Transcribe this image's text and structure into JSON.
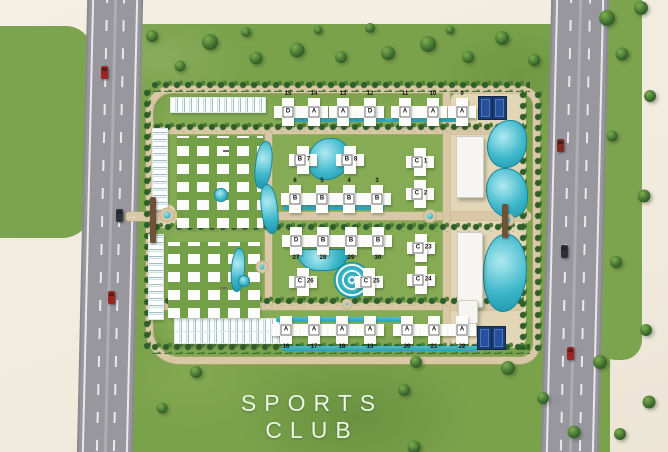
{
  "caption": {
    "line1": "SPORTS",
    "line2": "CLUB"
  },
  "entrances": {
    "west_arrow": "→",
    "east_arrow": "←"
  },
  "colors": {
    "background_cream": "#f2ecdf",
    "grass_green": "#7aa24b",
    "road_gray": "#98979d",
    "internal_road_tan": "#d8c8a6",
    "pool_teal": "#3fb8cb",
    "court_blue": "#1c3c74",
    "building_white": "#fcfcfa",
    "caption_green_white": "#e9f6e4"
  },
  "map": {
    "buildings": [
      {
        "num": "15",
        "letter": "D",
        "cls": "np-top",
        "x": 288,
        "y": 112
      },
      {
        "num": "14",
        "letter": "A",
        "cls": "np-top",
        "x": 314,
        "y": 112
      },
      {
        "num": "13",
        "letter": "A",
        "cls": "np-top",
        "x": 343,
        "y": 112
      },
      {
        "num": "12",
        "letter": "D",
        "cls": "np-top",
        "x": 370,
        "y": 112
      },
      {
        "num": "11",
        "letter": "A",
        "cls": "np-top",
        "x": 405,
        "y": 112
      },
      {
        "num": "10",
        "letter": "A",
        "cls": "np-top",
        "x": 433,
        "y": 112
      },
      {
        "num": "9",
        "letter": "A",
        "cls": "np-top",
        "x": 462,
        "y": 112
      },
      {
        "num": "7",
        "letter": "B",
        "cls": "np-right",
        "x": 303,
        "y": 160
      },
      {
        "num": "8",
        "letter": "B",
        "cls": "np-right",
        "x": 350,
        "y": 160
      },
      {
        "num": "1",
        "letter": "C",
        "cls": "np-right",
        "x": 420,
        "y": 162
      },
      {
        "num": "2",
        "letter": "C",
        "cls": "np-right",
        "x": 420,
        "y": 194
      },
      {
        "num": "6",
        "letter": "B",
        "cls": "np-top",
        "x": 295,
        "y": 199
      },
      {
        "num": "5",
        "letter": "B",
        "cls": "np-top",
        "x": 322,
        "y": 199
      },
      {
        "num": "4",
        "letter": "B",
        "cls": "np-top",
        "x": 349,
        "y": 199
      },
      {
        "num": "3",
        "letter": "B",
        "cls": "np-top",
        "x": 377,
        "y": 199
      },
      {
        "num": "27",
        "letter": "D",
        "cls": "np-bottom",
        "x": 296,
        "y": 241
      },
      {
        "num": "28",
        "letter": "B",
        "cls": "np-bottom",
        "x": 323,
        "y": 241
      },
      {
        "num": "29",
        "letter": "B",
        "cls": "np-bottom",
        "x": 351,
        "y": 241
      },
      {
        "num": "30",
        "letter": "B",
        "cls": "np-bottom",
        "x": 378,
        "y": 241
      },
      {
        "num": "23",
        "letter": "C",
        "cls": "np-right",
        "x": 421,
        "y": 248
      },
      {
        "num": "24",
        "letter": "C",
        "cls": "np-right",
        "x": 421,
        "y": 280
      },
      {
        "num": "26",
        "letter": "C",
        "cls": "np-right",
        "x": 303,
        "y": 282
      },
      {
        "num": "25",
        "letter": "C",
        "cls": "np-right",
        "x": 369,
        "y": 282
      },
      {
        "num": "16",
        "letter": "A",
        "cls": "np-bottom",
        "x": 286,
        "y": 330
      },
      {
        "num": "17",
        "letter": "A",
        "cls": "np-bottom",
        "x": 314,
        "y": 330
      },
      {
        "num": "18",
        "letter": "A",
        "cls": "np-bottom",
        "x": 342,
        "y": 330
      },
      {
        "num": "19",
        "letter": "A",
        "cls": "np-bottom",
        "x": 370,
        "y": 330
      },
      {
        "num": "20",
        "letter": "A",
        "cls": "np-bottom",
        "x": 407,
        "y": 330
      },
      {
        "num": "21",
        "letter": "A",
        "cls": "np-bottom",
        "x": 434,
        "y": 330
      },
      {
        "num": "22",
        "letter": "A",
        "cls": "np-bottom",
        "x": 462,
        "y": 330
      }
    ],
    "cluster_labels": [
      {
        "text": "B",
        "x": 226,
        "y": 151
      },
      {
        "text": "62",
        "x": 224,
        "y": 288
      }
    ],
    "clusters": [
      {
        "x": 170,
        "y": 97,
        "w": 94,
        "h": 14,
        "cls": "cl-hrow"
      },
      {
        "x": 174,
        "y": 318,
        "w": 106,
        "h": 12,
        "cls": "cl-hrow"
      },
      {
        "x": 174,
        "y": 331,
        "w": 106,
        "h": 11,
        "cls": "cl-hrow"
      },
      {
        "x": 152,
        "y": 128,
        "w": 14,
        "h": 80,
        "cls": "cl-vcol"
      },
      {
        "x": 148,
        "y": 234,
        "w": 14,
        "h": 84,
        "cls": "cl-vcol"
      },
      {
        "x": 177,
        "y": 136,
        "w": 86,
        "h": 92,
        "cls": "cl-grid"
      },
      {
        "x": 168,
        "y": 242,
        "w": 92,
        "h": 76,
        "cls": "cl-grid"
      }
    ],
    "slabs": [
      {
        "x": 456,
        "y": 136,
        "w": 26,
        "h": 60
      },
      {
        "x": 457,
        "y": 232,
        "w": 24,
        "h": 74
      },
      {
        "x": 458,
        "y": 300,
        "w": 18,
        "h": 22
      }
    ],
    "plazas": [
      {
        "x": 450,
        "y": 92,
        "w": 76,
        "h": 256
      },
      {
        "x": 150,
        "y": 204,
        "w": 26,
        "h": 24
      },
      {
        "x": 498,
        "y": 204,
        "w": 30,
        "h": 26
      }
    ],
    "courts": [
      {
        "x": 478,
        "y": 96,
        "w": 13,
        "h": 22
      },
      {
        "x": 492,
        "y": 96,
        "w": 13,
        "h": 22
      },
      {
        "x": 477,
        "y": 326,
        "w": 13,
        "h": 22
      },
      {
        "x": 491,
        "y": 326,
        "w": 13,
        "h": 22
      }
    ],
    "pools": [
      {
        "x": 308,
        "y": 138,
        "w": 40,
        "h": 40,
        "r": "55% 45% 60% 40%"
      },
      {
        "x": 296,
        "y": 249,
        "w": 52,
        "h": 20,
        "r": "0 0 26px 26px"
      },
      {
        "x": 334,
        "y": 262,
        "w": 34,
        "h": 34,
        "r": "50%",
        "cls": "t-spiral"
      },
      {
        "x": 255,
        "y": 141,
        "w": 15,
        "h": 46,
        "r": "45%",
        "a": 7
      },
      {
        "x": 261,
        "y": 184,
        "w": 15,
        "h": 48,
        "r": "45%",
        "a": -7
      },
      {
        "x": 231,
        "y": 248,
        "w": 12,
        "h": 42,
        "r": "45%",
        "a": 4
      },
      {
        "x": 487,
        "y": 120,
        "w": 38,
        "h": 46,
        "r": "60% 40% 55% 45%"
      },
      {
        "x": 486,
        "y": 168,
        "w": 40,
        "h": 48,
        "r": "45% 55% 40% 60%"
      },
      {
        "x": 483,
        "y": 234,
        "w": 42,
        "h": 76,
        "r": "50% 45% 55% 45%"
      },
      {
        "x": 214,
        "y": 188,
        "w": 12,
        "h": 12,
        "r": "50%"
      },
      {
        "x": 238,
        "y": 275,
        "w": 10,
        "h": 10,
        "r": "50%"
      },
      {
        "x": 286,
        "y": 118,
        "w": 178,
        "h": 4,
        "r": "2px",
        "cls": "t-strip"
      },
      {
        "x": 283,
        "y": 205,
        "w": 102,
        "h": 5,
        "r": "2px",
        "cls": "t-strip"
      },
      {
        "x": 276,
        "y": 317,
        "w": 128,
        "h": 5,
        "r": "2px",
        "cls": "t-strip"
      },
      {
        "x": 282,
        "y": 346,
        "w": 196,
        "h": 5,
        "r": "2px",
        "cls": "t-strip"
      }
    ],
    "roundabouts": [
      {
        "x": 167,
        "y": 215,
        "s": 13
      },
      {
        "x": 262,
        "y": 267,
        "s": 11
      },
      {
        "x": 430,
        "y": 216,
        "s": 12
      },
      {
        "x": 508,
        "y": 220,
        "s": 11
      },
      {
        "x": 347,
        "y": 304,
        "s": 9
      }
    ],
    "internal_roads": [
      {
        "x": 152,
        "y": 127,
        "w": 370,
        "h": 7
      },
      {
        "x": 152,
        "y": 212,
        "w": 370,
        "h": 8
      },
      {
        "x": 152,
        "y": 303,
        "w": 370,
        "h": 7
      },
      {
        "x": 265,
        "y": 131,
        "w": 7,
        "h": 178
      },
      {
        "x": 443,
        "y": 92,
        "w": 7,
        "h": 256
      },
      {
        "x": 126,
        "y": 212,
        "w": 28,
        "h": 9
      },
      {
        "x": 505,
        "y": 212,
        "w": 26,
        "h": 9
      }
    ],
    "hedges": [
      {
        "x": 150,
        "y": 80,
        "w": 380,
        "h": 12
      },
      {
        "x": 152,
        "y": 122,
        "w": 372,
        "h": 10
      },
      {
        "x": 152,
        "y": 222,
        "w": 372,
        "h": 10
      },
      {
        "x": 152,
        "y": 296,
        "w": 372,
        "h": 10
      },
      {
        "x": 150,
        "y": 342,
        "w": 380,
        "h": 12
      },
      {
        "x": 142,
        "y": 88,
        "w": 11,
        "h": 262,
        "cls": "hedge-v"
      },
      {
        "x": 518,
        "y": 90,
        "w": 10,
        "h": 260,
        "cls": "hedge-v"
      },
      {
        "x": 533,
        "y": 90,
        "w": 10,
        "h": 262,
        "cls": "hedge-v"
      }
    ],
    "gates": [
      {
        "x": 150,
        "y": 197,
        "w": 6,
        "h": 46
      },
      {
        "x": 502,
        "y": 204,
        "w": 6,
        "h": 34
      }
    ],
    "trees": [
      {
        "x": 210,
        "y": 42,
        "s": 16
      },
      {
        "x": 256,
        "y": 58,
        "s": 13
      },
      {
        "x": 297,
        "y": 50,
        "s": 15
      },
      {
        "x": 341,
        "y": 57,
        "s": 12
      },
      {
        "x": 388,
        "y": 53,
        "s": 14
      },
      {
        "x": 428,
        "y": 44,
        "s": 16
      },
      {
        "x": 468,
        "y": 57,
        "s": 12
      },
      {
        "x": 502,
        "y": 38,
        "s": 14
      },
      {
        "x": 534,
        "y": 60,
        "s": 12
      },
      {
        "x": 180,
        "y": 66,
        "s": 11
      },
      {
        "x": 152,
        "y": 36,
        "s": 12
      },
      {
        "x": 246,
        "y": 32,
        "s": 10
      },
      {
        "x": 318,
        "y": 30,
        "s": 9
      },
      {
        "x": 370,
        "y": 28,
        "s": 10
      },
      {
        "x": 450,
        "y": 30,
        "s": 9
      },
      {
        "x": 607,
        "y": 18,
        "s": 16
      },
      {
        "x": 641,
        "y": 8,
        "s": 14
      },
      {
        "x": 622,
        "y": 54,
        "s": 13
      },
      {
        "x": 650,
        "y": 96,
        "s": 12
      },
      {
        "x": 612,
        "y": 136,
        "s": 11
      },
      {
        "x": 644,
        "y": 196,
        "s": 13
      },
      {
        "x": 616,
        "y": 262,
        "s": 12
      },
      {
        "x": 646,
        "y": 330,
        "s": 12
      },
      {
        "x": 600,
        "y": 362,
        "s": 14
      },
      {
        "x": 649,
        "y": 402,
        "s": 13
      },
      {
        "x": 620,
        "y": 434,
        "s": 12
      },
      {
        "x": 196,
        "y": 372,
        "s": 12
      },
      {
        "x": 416,
        "y": 362,
        "s": 12
      },
      {
        "x": 508,
        "y": 368,
        "s": 14
      },
      {
        "x": 543,
        "y": 398,
        "s": 12
      },
      {
        "x": 574,
        "y": 432,
        "s": 13
      },
      {
        "x": 162,
        "y": 408,
        "s": 11
      },
      {
        "x": 404,
        "y": 390,
        "s": 12
      },
      {
        "x": 414,
        "y": 447,
        "s": 13
      }
    ],
    "cars": [
      {
        "x": 101,
        "y": 66,
        "c": "#9b2420"
      },
      {
        "x": 116,
        "y": 209,
        "c": "#32343a"
      },
      {
        "x": 108,
        "y": 291,
        "c": "#9b2420"
      },
      {
        "x": 557,
        "y": 139,
        "c": "#7c2a22"
      },
      {
        "x": 561,
        "y": 245,
        "c": "#2e3036"
      },
      {
        "x": 567,
        "y": 347,
        "c": "#9b2420"
      }
    ]
  }
}
